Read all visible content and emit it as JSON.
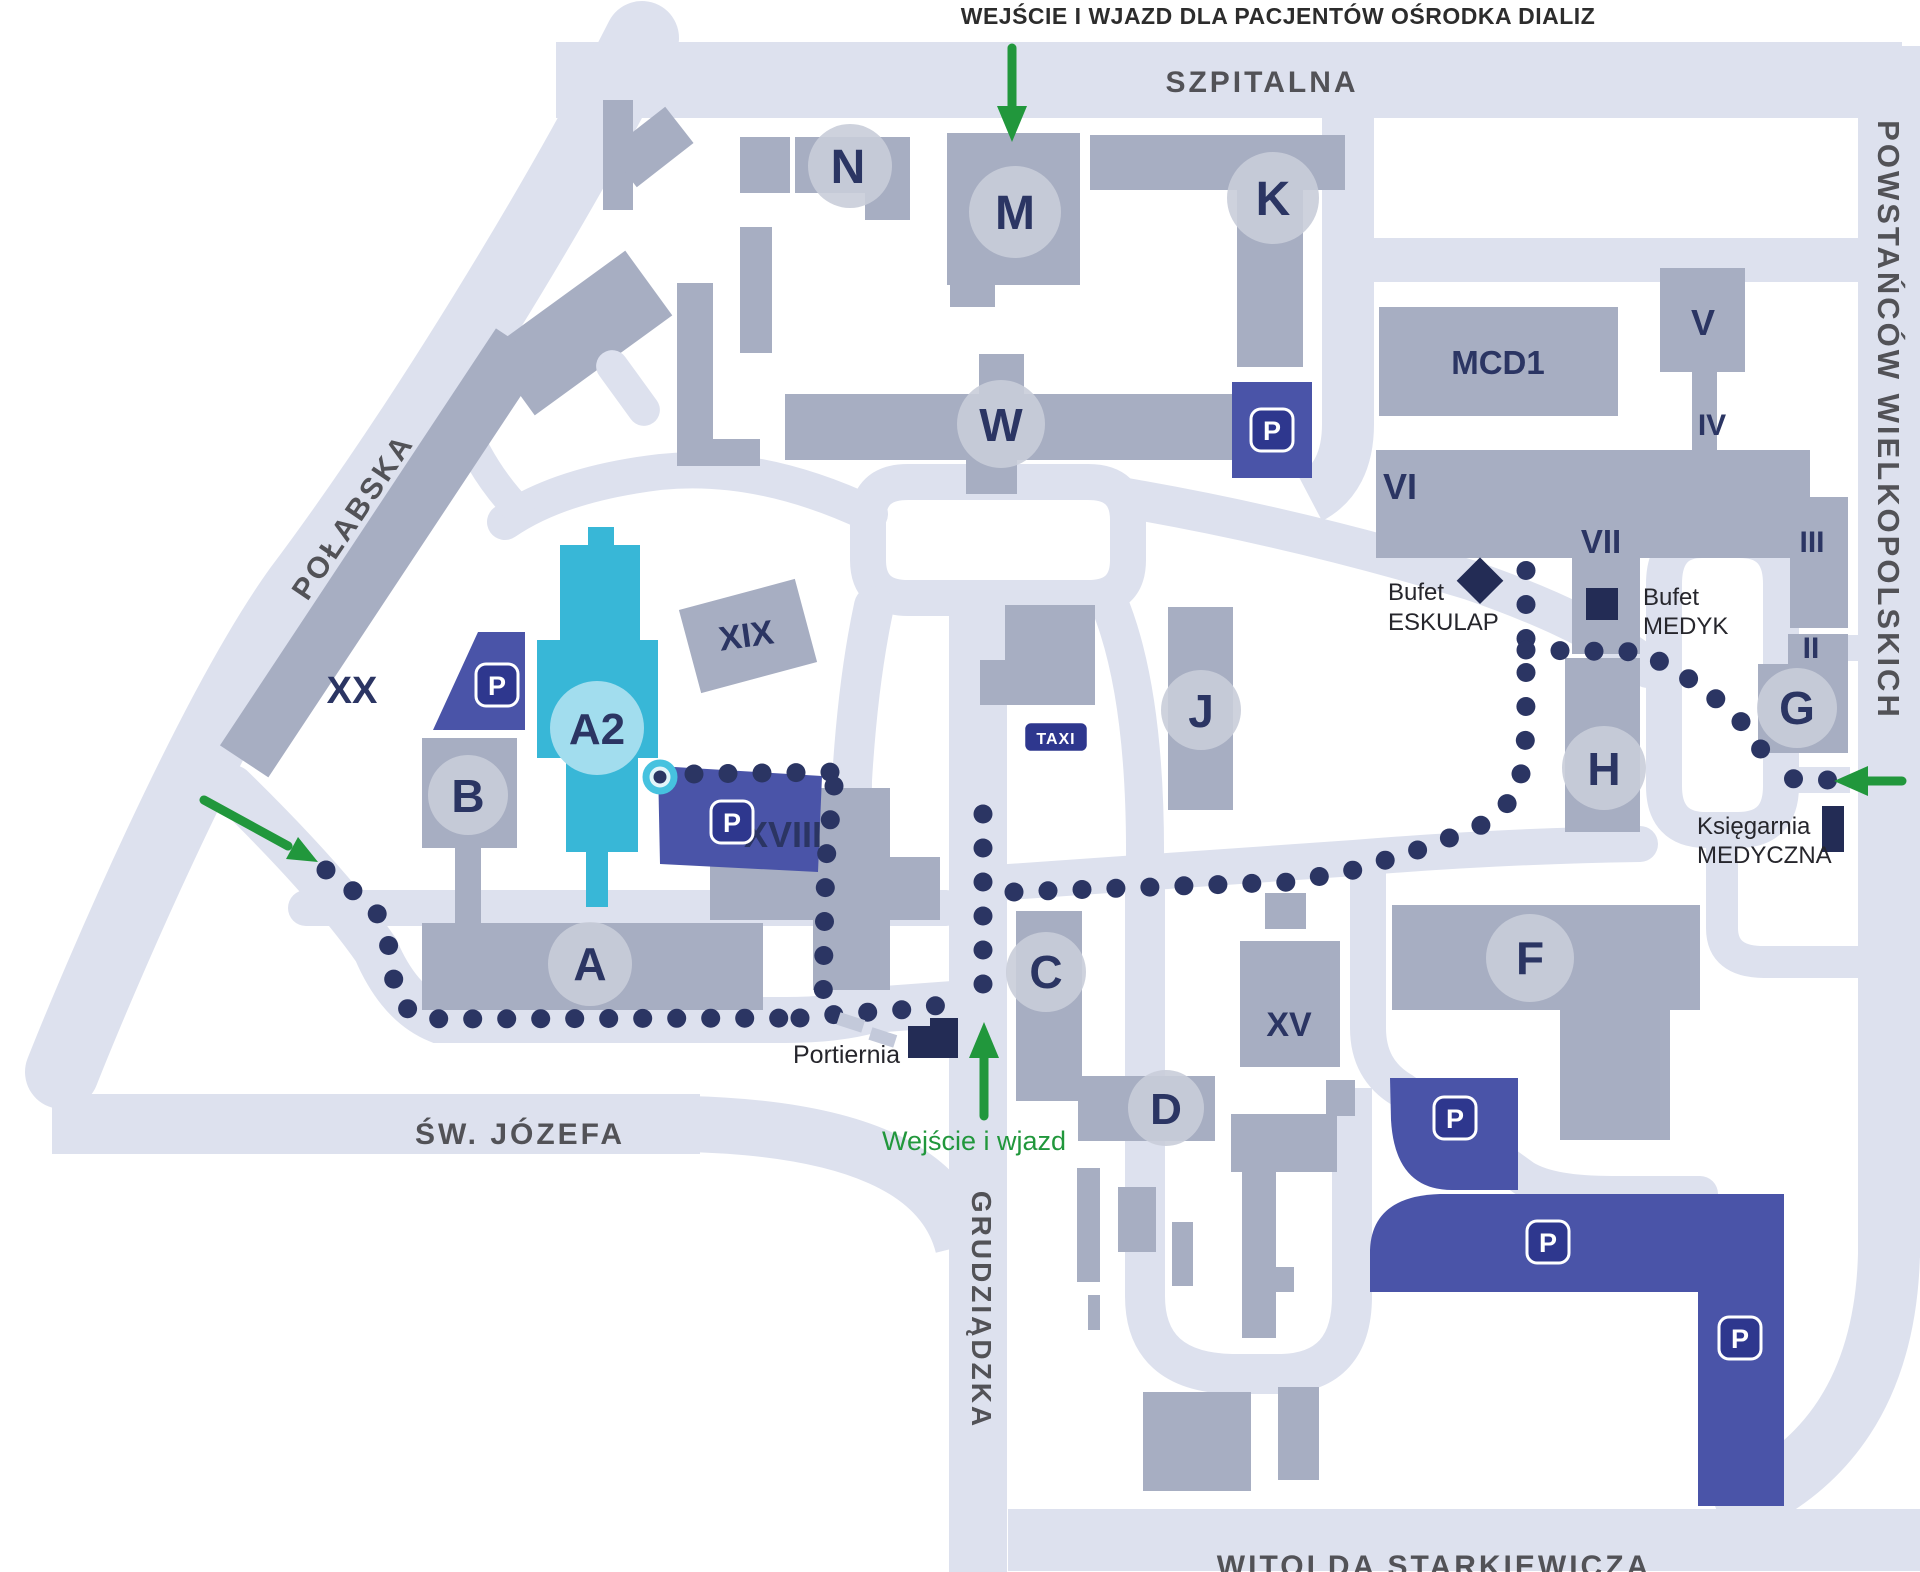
{
  "note_top": "WEJŚCIE I WJAZD DLA PACJENTÓW OŚRODKA DIALIZ",
  "entrance_label": "Wejście i wjazd",
  "streets": {
    "szpitalna": "SZPITALNA",
    "powstancow": "POWSTAŃCÓW WIELKOPOLSKICH",
    "polabska": "POŁABSKA",
    "jozefa": "ŚW. JÓZEFA",
    "grudziadzka": "GRUDZIĄDZKA",
    "witolda": "WITOLDA STARKIEWICZA"
  },
  "buildings": {
    "n": "N",
    "m": "M",
    "k": "K",
    "w": "W",
    "mcd1": "MCD1",
    "v": "V",
    "iv": "IV",
    "vi": "VI",
    "vii": "VII",
    "iii": "III",
    "ii": "II",
    "g": "G",
    "h": "H",
    "j": "J",
    "f": "F",
    "c": "C",
    "d": "D",
    "xv": "XV",
    "xviii": "XVIII",
    "xix": "XIX",
    "xx": "XX",
    "a": "A",
    "a2": "A2",
    "b": "B"
  },
  "poi": {
    "bufet_eskulap_line1": "Bufet",
    "bufet_eskulap_line2": "ESKULAP",
    "bufet_medyk_line1": "Bufet",
    "bufet_medyk_line2": "MEDYK",
    "ksiegarnia_line1": "Księgarnia",
    "ksiegarnia_line2": "MEDYCZNA",
    "portiernia": "Portiernia",
    "taxi": "TAXI"
  },
  "parking": {
    "label": "P"
  },
  "colors": {
    "road": "#dde1ee",
    "building": "#a7aec2",
    "building_circle": "#c9cdd9",
    "navy": "#2b3563",
    "cyan": "#38b7d7",
    "cyan_light": "#a2ddee",
    "parking_area": "#4a54a8",
    "parking_icon": "#2e378e",
    "dark_marker": "#232c55",
    "green": "#21973c",
    "street_text": "#3a3a3d"
  }
}
